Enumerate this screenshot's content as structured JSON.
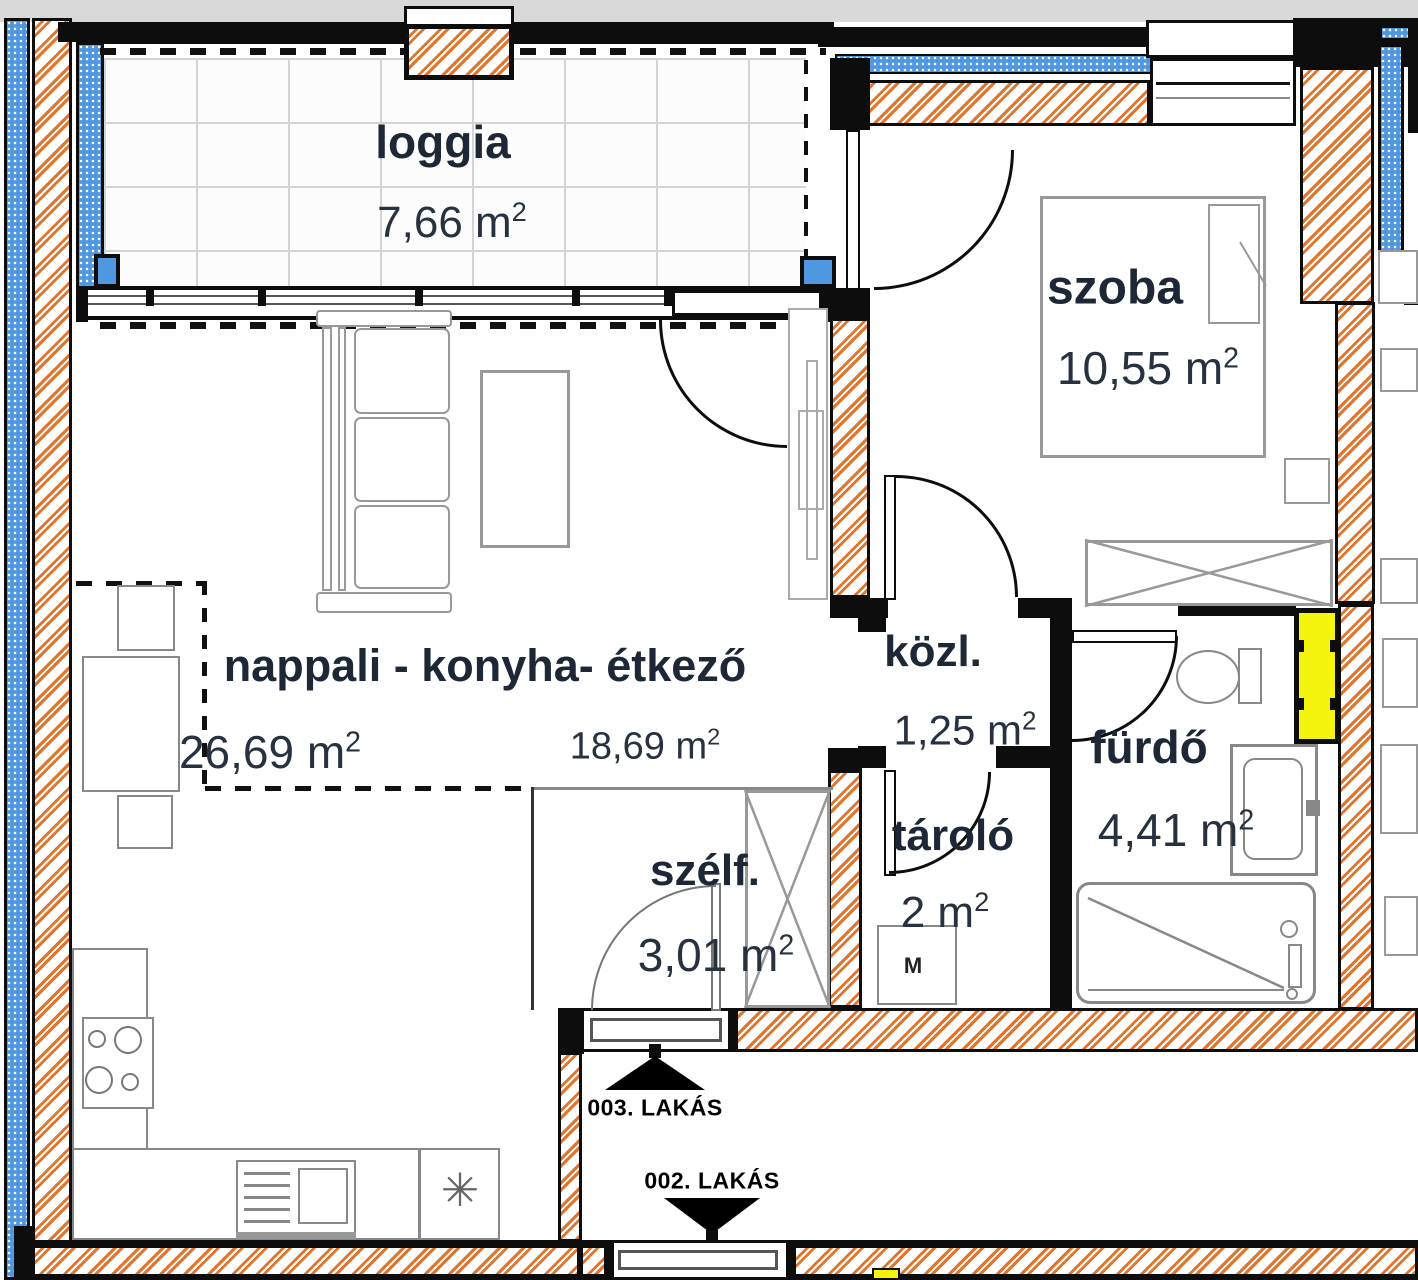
{
  "title": "apartment floor plan",
  "rooms": {
    "loggia": {
      "name": "loggia",
      "area": "7,66 m",
      "sup": "2"
    },
    "szoba": {
      "name": "szoba",
      "area": "10,55 m",
      "sup": "2"
    },
    "nappali": {
      "name": "nappali - konyha- étkező",
      "area_total": "26,69 m",
      "area_total_sup": "2",
      "area_part": "18,69 m",
      "area_part_sup": "2"
    },
    "kozl": {
      "name": "közl.",
      "area": "1,25 m",
      "sup": "2"
    },
    "furdo": {
      "name": "fürdő",
      "area": "4,41 m",
      "sup": "2"
    },
    "tarolo": {
      "name": "tároló",
      "area": "2 m",
      "sup": "2",
      "machine": "M"
    },
    "szelf": {
      "name": "szélf.",
      "area": "3,01 m",
      "sup": "2"
    }
  },
  "corridor": {
    "apartment_up": "003. LAKÁS",
    "apartment_down": "002. LAKÁS"
  },
  "kitchen": {
    "appliance_symbol": "✳"
  },
  "colors": {
    "wall": "#0d0d0d",
    "hatch_orange": "#e0762e",
    "insulation_blue": "#4f97e0",
    "shaft_yellow": "#f4f40c",
    "furniture_gray": "#999999",
    "text": "#1d2735",
    "background_gray": "#d9d9d9"
  }
}
